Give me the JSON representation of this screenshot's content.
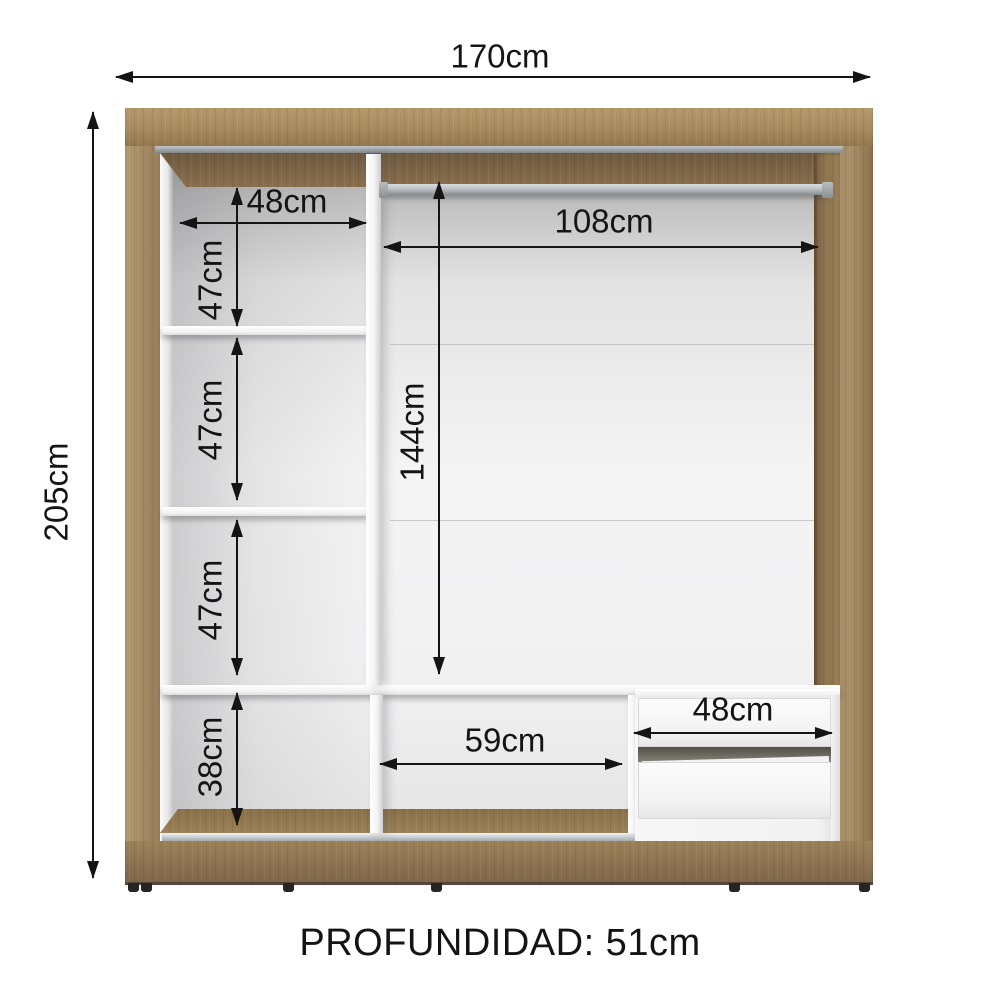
{
  "figure": {
    "kind": "wardrobe interior dimension diagram"
  },
  "dimensions": {
    "total_width": "170cm",
    "total_height": "205cm",
    "left_column_width": "48cm",
    "left_gap_top": "47cm",
    "left_gap_middle": "47cm",
    "left_gap_bottom": "47cm",
    "base_left_height": "38cm",
    "hanging_section_width": "108cm",
    "hanging_section_height": "144cm",
    "base_middle_width": "59cm",
    "drawer_unit_width": "48cm"
  },
  "caption": {
    "depth": "PROFUNDIDAD: 51cm"
  },
  "colors": {
    "wood": "#9c8158",
    "wood_dark": "#7d6547",
    "wood_light": "#a78a5e",
    "interior_wall": "#f1f1f2",
    "rod_metal": "#c2c6c8",
    "annotation_ink": "#141414"
  }
}
